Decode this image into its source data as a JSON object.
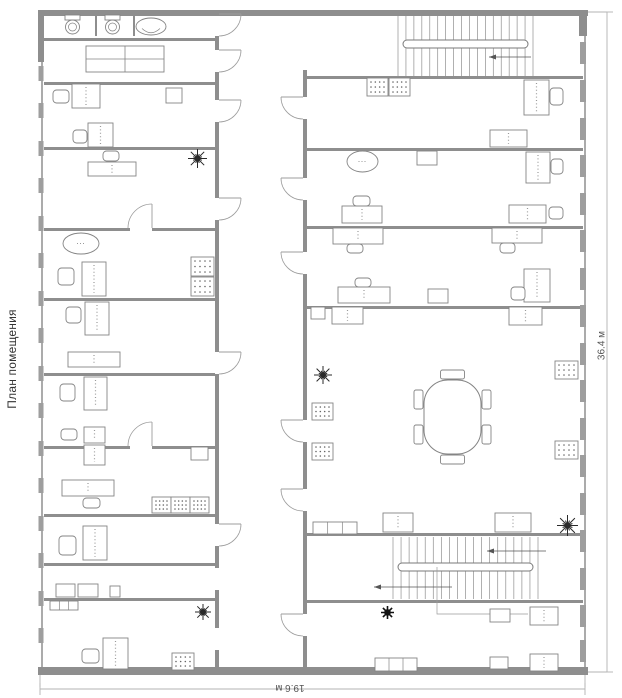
{
  "title": {
    "text": "План помещения"
  },
  "dimensions": {
    "width": "19.6 м",
    "height": "36.4 м"
  },
  "colors": {
    "wall": "#8e8e8e",
    "wall_line": "#ababab",
    "window": "#9e9e9e",
    "furniture": "#848484",
    "door": "#9c9c9c",
    "dim": "#b3b3b3",
    "plant": "#2a2a2a",
    "text": "#3c3c3c"
  },
  "plan": {
    "wall_lines": [
      [
        41,
        16,
        2,
        651
      ],
      [
        584,
        16,
        2,
        651
      ]
    ],
    "walls": [
      [
        38,
        10,
        550,
        6
      ],
      [
        38,
        667,
        550,
        8
      ],
      [
        38,
        10,
        6,
        52
      ],
      [
        579,
        10,
        8,
        26
      ],
      [
        95,
        12,
        2,
        24
      ],
      [
        133,
        12,
        2,
        24
      ],
      [
        44,
        38,
        171,
        3
      ],
      [
        44,
        82,
        171,
        3
      ],
      [
        44,
        147,
        171,
        3
      ],
      [
        44,
        228,
        86,
        3
      ],
      [
        152,
        228,
        63,
        3
      ],
      [
        44,
        298,
        171,
        3
      ],
      [
        44,
        373,
        171,
        3
      ],
      [
        44,
        446,
        86,
        3
      ],
      [
        152,
        446,
        63,
        3
      ],
      [
        44,
        514,
        171,
        3
      ],
      [
        44,
        563,
        171,
        3
      ],
      [
        44,
        598,
        171,
        3
      ],
      [
        215,
        36,
        4,
        14
      ],
      [
        215,
        72,
        4,
        28
      ],
      [
        215,
        122,
        4,
        76
      ],
      [
        215,
        220,
        4,
        132
      ],
      [
        215,
        374,
        4,
        150
      ],
      [
        215,
        546,
        4,
        22
      ],
      [
        215,
        590,
        4,
        38
      ],
      [
        215,
        650,
        4,
        18
      ],
      [
        303,
        70,
        4,
        27
      ],
      [
        303,
        119,
        4,
        59
      ],
      [
        303,
        200,
        4,
        52
      ],
      [
        303,
        274,
        4,
        146
      ],
      [
        303,
        442,
        4,
        47
      ],
      [
        303,
        511,
        4,
        103
      ],
      [
        303,
        636,
        4,
        32
      ],
      [
        303,
        76,
        280,
        3
      ],
      [
        307,
        148,
        276,
        3
      ],
      [
        307,
        226,
        276,
        3
      ],
      [
        307,
        306,
        276,
        3
      ],
      [
        307,
        533,
        276,
        3
      ],
      [
        307,
        600,
        276,
        3
      ]
    ],
    "windows_left": {
      "x": 38.5,
      "w": 5,
      "h": 15,
      "ys": [
        66,
        103,
        141,
        178,
        216,
        253,
        291,
        328,
        366,
        403,
        441,
        478,
        516,
        553,
        591,
        628
      ]
    },
    "windows_right": {
      "x": 580,
      "w": 6,
      "h": 22,
      "ys": [
        42,
        80,
        118,
        155,
        193,
        230,
        268,
        305,
        343,
        380,
        418,
        455,
        493,
        530,
        568,
        605,
        640
      ]
    },
    "doors": [
      {
        "t": "vr",
        "x": 219,
        "y": 14,
        "len": 22
      },
      {
        "t": "vr",
        "x": 219,
        "y": 50,
        "len": 22
      },
      {
        "t": "vr",
        "x": 219,
        "y": 100,
        "len": 22
      },
      {
        "t": "vr",
        "x": 219,
        "y": 198,
        "len": 22
      },
      {
        "t": "vr",
        "x": 219,
        "y": 352,
        "len": 22
      },
      {
        "t": "vr",
        "x": 219,
        "y": 524,
        "len": 22
      },
      {
        "t": "vl",
        "x": 303,
        "y": 97,
        "len": 22
      },
      {
        "t": "vl",
        "x": 303,
        "y": 178,
        "len": 22
      },
      {
        "t": "vl",
        "x": 303,
        "y": 252,
        "len": 22
      },
      {
        "t": "vl",
        "x": 303,
        "y": 420,
        "len": 22
      },
      {
        "t": "vl",
        "x": 303,
        "y": 489,
        "len": 22
      },
      {
        "t": "vl",
        "x": 303,
        "y": 614,
        "len": 22
      },
      {
        "t": "hu",
        "x": 152,
        "y": 228,
        "len": 24
      },
      {
        "t": "hu",
        "x": 152,
        "y": 446,
        "len": 24
      }
    ],
    "stairs": [
      {
        "x": 398,
        "y": 16,
        "w": 135,
        "h": 60,
        "rail": [
          403,
          40,
          125,
          8
        ],
        "n": 18,
        "arrows": [
          [
            531,
            57,
            489,
            57
          ]
        ]
      },
      {
        "x": 393,
        "y": 537,
        "w": 145,
        "h": 62,
        "rail": [
          398,
          563,
          135,
          8
        ],
        "n": 19,
        "arrows": [
          [
            546,
            551,
            487,
            551
          ],
          [
            452,
            587,
            374,
            587
          ]
        ],
        "leader": [
          [
            437,
            567
          ],
          [
            437,
            614
          ],
          [
            528,
            614
          ]
        ]
      }
    ],
    "furniture": [
      {
        "t": "toilet",
        "x": 62,
        "y": 15,
        "w": 21,
        "h": 21
      },
      {
        "t": "toilet",
        "x": 102,
        "y": 15,
        "w": 21,
        "h": 21
      },
      {
        "t": "sink",
        "x": 136,
        "y": 18,
        "w": 30,
        "h": 17
      },
      {
        "t": "tablegrid",
        "x": 86,
        "y": 46,
        "w": 78,
        "h": 26
      },
      {
        "t": "desk",
        "x": 72,
        "y": 84,
        "w": 28,
        "h": 24
      },
      {
        "t": "chair",
        "x": 53,
        "y": 90,
        "w": 16,
        "h": 13
      },
      {
        "t": "shelf",
        "x": 166,
        "y": 88,
        "w": 16,
        "h": 15
      },
      {
        "t": "desk",
        "x": 88,
        "y": 123,
        "w": 25,
        "h": 24
      },
      {
        "t": "chair",
        "x": 73,
        "y": 130,
        "w": 14,
        "h": 13
      },
      {
        "t": "chair",
        "x": 103,
        "y": 151,
        "w": 16,
        "h": 10
      },
      {
        "t": "deskh",
        "x": 88,
        "y": 162,
        "w": 48,
        "h": 14
      },
      {
        "t": "plant",
        "x": 188,
        "y": 149,
        "w": 19,
        "h": 19
      },
      {
        "t": "oval",
        "x": 63,
        "y": 233,
        "w": 36,
        "h": 21
      },
      {
        "t": "desk",
        "x": 82,
        "y": 262,
        "w": 24,
        "h": 34
      },
      {
        "t": "chair",
        "x": 58,
        "y": 268,
        "w": 16,
        "h": 17
      },
      {
        "t": "armchair",
        "x": 191,
        "y": 257,
        "w": 23,
        "h": 19
      },
      {
        "t": "armchair",
        "x": 191,
        "y": 277,
        "w": 23,
        "h": 19
      },
      {
        "t": "desk",
        "x": 85,
        "y": 302,
        "w": 24,
        "h": 33
      },
      {
        "t": "chair",
        "x": 66,
        "y": 307,
        "w": 15,
        "h": 16
      },
      {
        "t": "deskh",
        "x": 68,
        "y": 352,
        "w": 52,
        "h": 15
      },
      {
        "t": "desk",
        "x": 84,
        "y": 377,
        "w": 23,
        "h": 33
      },
      {
        "t": "chair",
        "x": 60,
        "y": 384,
        "w": 15,
        "h": 17
      },
      {
        "t": "desk",
        "x": 84,
        "y": 427,
        "w": 21,
        "h": 16
      },
      {
        "t": "desk",
        "x": 84,
        "y": 445,
        "w": 21,
        "h": 20
      },
      {
        "t": "chair",
        "x": 61,
        "y": 429,
        "w": 16,
        "h": 11
      },
      {
        "t": "deskh",
        "x": 62,
        "y": 480,
        "w": 52,
        "h": 16
      },
      {
        "t": "chair",
        "x": 83,
        "y": 498,
        "w": 17,
        "h": 10
      },
      {
        "t": "armchair",
        "x": 152,
        "y": 497,
        "w": 19,
        "h": 16
      },
      {
        "t": "armchair",
        "x": 171,
        "y": 497,
        "w": 19,
        "h": 16
      },
      {
        "t": "armchair",
        "x": 190,
        "y": 497,
        "w": 19,
        "h": 16
      },
      {
        "t": "shelf",
        "x": 191,
        "y": 447,
        "w": 17,
        "h": 13
      },
      {
        "t": "desk",
        "x": 83,
        "y": 526,
        "w": 24,
        "h": 34
      },
      {
        "t": "chair",
        "x": 59,
        "y": 536,
        "w": 17,
        "h": 19
      },
      {
        "t": "shelf",
        "x": 56,
        "y": 584,
        "w": 19,
        "h": 13
      },
      {
        "t": "shelf",
        "x": 78,
        "y": 584,
        "w": 20,
        "h": 13
      },
      {
        "t": "shelf",
        "x": 110,
        "y": 586,
        "w": 10,
        "h": 11
      },
      {
        "t": "sideboard",
        "x": 50,
        "y": 601,
        "w": 28,
        "h": 9
      },
      {
        "t": "plant",
        "x": 195,
        "y": 604,
        "w": 16,
        "h": 16
      },
      {
        "t": "desk",
        "x": 103,
        "y": 638,
        "w": 25,
        "h": 31
      },
      {
        "t": "chair",
        "x": 82,
        "y": 649,
        "w": 17,
        "h": 14
      },
      {
        "t": "armchair",
        "x": 172,
        "y": 653,
        "w": 22,
        "h": 17
      },
      {
        "t": "armchair",
        "x": 367,
        "y": 78,
        "w": 21,
        "h": 18
      },
      {
        "t": "armchair",
        "x": 389,
        "y": 78,
        "w": 21,
        "h": 18
      },
      {
        "t": "desk",
        "x": 524,
        "y": 80,
        "w": 25,
        "h": 35
      },
      {
        "t": "chair",
        "x": 550,
        "y": 88,
        "w": 13,
        "h": 17
      },
      {
        "t": "deskh",
        "x": 490,
        "y": 130,
        "w": 37,
        "h": 17
      },
      {
        "t": "oval",
        "x": 347,
        "y": 151,
        "w": 31,
        "h": 21
      },
      {
        "t": "shelf",
        "x": 417,
        "y": 151,
        "w": 20,
        "h": 14
      },
      {
        "t": "desk",
        "x": 526,
        "y": 152,
        "w": 24,
        "h": 31
      },
      {
        "t": "chair",
        "x": 551,
        "y": 159,
        "w": 12,
        "h": 15
      },
      {
        "t": "deskh",
        "x": 342,
        "y": 206,
        "w": 40,
        "h": 17
      },
      {
        "t": "chair",
        "x": 353,
        "y": 196,
        "w": 17,
        "h": 10
      },
      {
        "t": "deskh",
        "x": 509,
        "y": 205,
        "w": 37,
        "h": 18
      },
      {
        "t": "chair",
        "x": 549,
        "y": 207,
        "w": 14,
        "h": 12
      },
      {
        "t": "deskh",
        "x": 333,
        "y": 228,
        "w": 50,
        "h": 16
      },
      {
        "t": "chair",
        "x": 347,
        "y": 244,
        "w": 16,
        "h": 9
      },
      {
        "t": "deskh",
        "x": 492,
        "y": 228,
        "w": 50,
        "h": 15
      },
      {
        "t": "chair",
        "x": 500,
        "y": 243,
        "w": 15,
        "h": 10
      },
      {
        "t": "deskh",
        "x": 338,
        "y": 287,
        "w": 52,
        "h": 16
      },
      {
        "t": "chair",
        "x": 355,
        "y": 278,
        "w": 16,
        "h": 9
      },
      {
        "t": "shelf",
        "x": 428,
        "y": 289,
        "w": 20,
        "h": 14
      },
      {
        "t": "desk",
        "x": 524,
        "y": 269,
        "w": 26,
        "h": 33
      },
      {
        "t": "chair",
        "x": 511,
        "y": 287,
        "w": 14,
        "h": 13
      },
      {
        "t": "shelf",
        "x": 311,
        "y": 307,
        "w": 14,
        "h": 12
      },
      {
        "t": "deskh",
        "x": 332,
        "y": 307,
        "w": 31,
        "h": 17
      },
      {
        "t": "deskh",
        "x": 509,
        "y": 307,
        "w": 33,
        "h": 18
      },
      {
        "t": "conftable",
        "x": 424,
        "y": 380,
        "w": 57,
        "h": 74
      },
      {
        "t": "armchair",
        "x": 312,
        "y": 403,
        "w": 21,
        "h": 17
      },
      {
        "t": "armchair",
        "x": 312,
        "y": 443,
        "w": 21,
        "h": 17
      },
      {
        "t": "plant",
        "x": 314,
        "y": 366,
        "w": 18,
        "h": 18
      },
      {
        "t": "armchair",
        "x": 555,
        "y": 361,
        "w": 23,
        "h": 18
      },
      {
        "t": "armchair",
        "x": 555,
        "y": 441,
        "w": 23,
        "h": 18
      },
      {
        "t": "sideboard",
        "x": 313,
        "y": 522,
        "w": 44,
        "h": 12
      },
      {
        "t": "deskh",
        "x": 383,
        "y": 513,
        "w": 30,
        "h": 19
      },
      {
        "t": "deskh",
        "x": 495,
        "y": 513,
        "w": 36,
        "h": 19
      },
      {
        "t": "plant",
        "x": 557,
        "y": 515,
        "w": 21,
        "h": 21
      },
      {
        "t": "plantdark",
        "x": 381,
        "y": 607,
        "w": 13,
        "h": 11
      },
      {
        "t": "shelf",
        "x": 490,
        "y": 609,
        "w": 20,
        "h": 13
      },
      {
        "t": "deskh",
        "x": 530,
        "y": 607,
        "w": 28,
        "h": 18
      },
      {
        "t": "sideboard",
        "x": 375,
        "y": 658,
        "w": 42,
        "h": 13
      },
      {
        "t": "shelf",
        "x": 490,
        "y": 657,
        "w": 18,
        "h": 12
      },
      {
        "t": "deskh",
        "x": 530,
        "y": 654,
        "w": 28,
        "h": 17
      }
    ],
    "dim_lines": [
      [
        40,
        689,
        585,
        689
      ],
      [
        40,
        683,
        40,
        695
      ],
      [
        585,
        683,
        585,
        695
      ],
      [
        40,
        675,
        40,
        687
      ],
      [
        585,
        675,
        585,
        687
      ],
      [
        607,
        12,
        607,
        672
      ],
      [
        601,
        12,
        613,
        12
      ],
      [
        601,
        672,
        613,
        672
      ],
      [
        588,
        12,
        607,
        12
      ],
      [
        588,
        672,
        607,
        672
      ]
    ]
  }
}
